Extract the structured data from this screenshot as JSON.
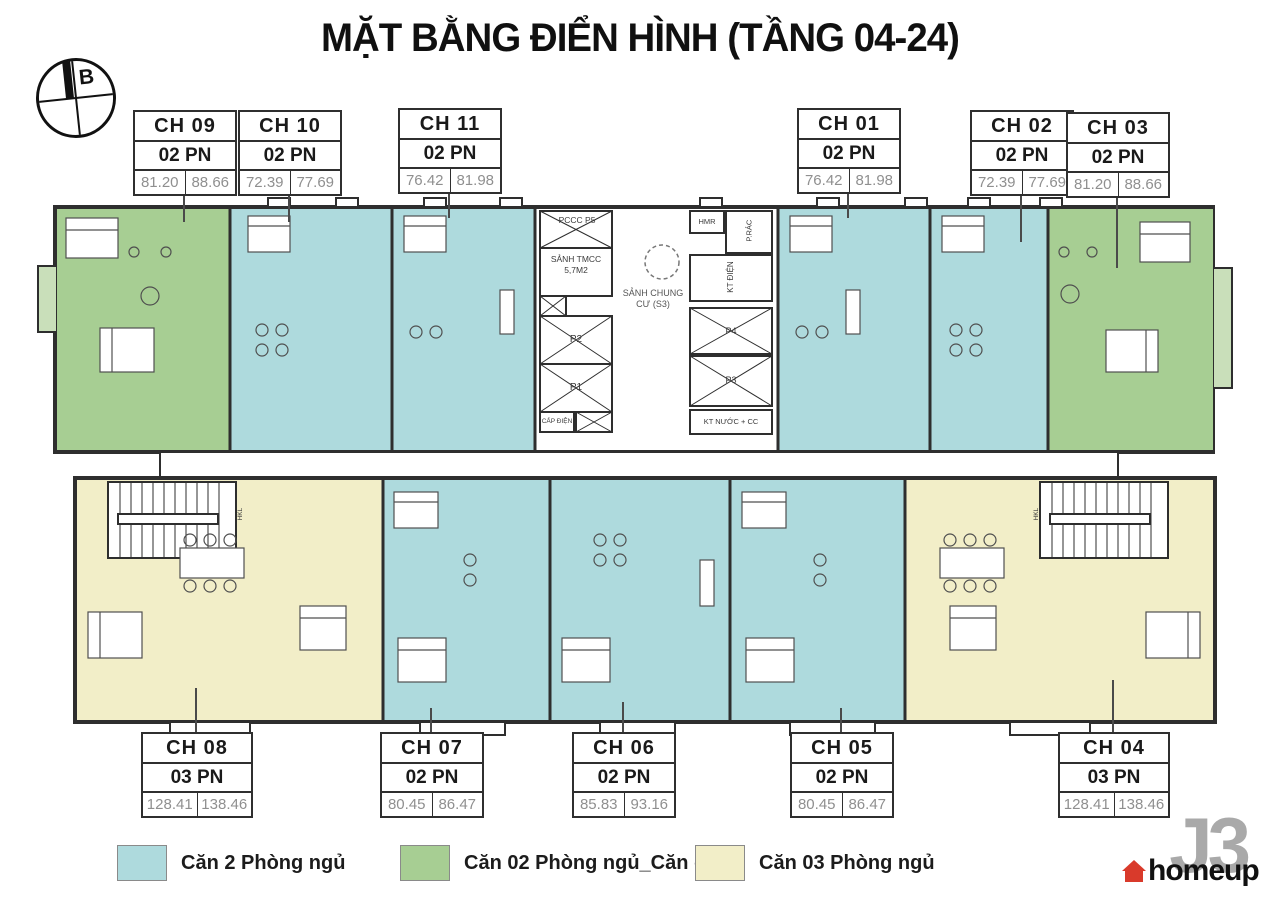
{
  "title": "MẶT BẰNG ĐIỂN HÌNH (TẦNG 04-24)",
  "compass": {
    "label": "B"
  },
  "units": [
    {
      "id": "CH09",
      "name": "CH 09",
      "bedrooms": "02 PN",
      "area1": "81.20",
      "area2": "88.66",
      "category": "2pn-corner"
    },
    {
      "id": "CH10",
      "name": "CH 10",
      "bedrooms": "02 PN",
      "area1": "72.39",
      "area2": "77.69",
      "category": "2pn"
    },
    {
      "id": "CH11",
      "name": "CH 11",
      "bedrooms": "02 PN",
      "area1": "76.42",
      "area2": "81.98",
      "category": "2pn"
    },
    {
      "id": "CH01",
      "name": "CH 01",
      "bedrooms": "02 PN",
      "area1": "76.42",
      "area2": "81.98",
      "category": "2pn"
    },
    {
      "id": "CH02",
      "name": "CH 02",
      "bedrooms": "02 PN",
      "area1": "72.39",
      "area2": "77.69",
      "category": "2pn"
    },
    {
      "id": "CH03",
      "name": "CH 03",
      "bedrooms": "02 PN",
      "area1": "81.20",
      "area2": "88.66",
      "category": "2pn-corner"
    },
    {
      "id": "CH08",
      "name": "CH 08",
      "bedrooms": "03 PN",
      "area1": "128.41",
      "area2": "138.46",
      "category": "3pn"
    },
    {
      "id": "CH07",
      "name": "CH 07",
      "bedrooms": "02 PN",
      "area1": "80.45",
      "area2": "86.47",
      "category": "2pn"
    },
    {
      "id": "CH06",
      "name": "CH 06",
      "bedrooms": "02 PN",
      "area1": "85.83",
      "area2": "93.16",
      "category": "2pn"
    },
    {
      "id": "CH05",
      "name": "CH 05",
      "bedrooms": "02 PN",
      "area1": "80.45",
      "area2": "86.47",
      "category": "2pn"
    },
    {
      "id": "CH04",
      "name": "CH 04",
      "bedrooms": "03 PN",
      "area1": "128.41",
      "area2": "138.46",
      "category": "3pn"
    }
  ],
  "core": {
    "fire_lift": "PCCC P5",
    "fire_lobby": "SẢNH TMCC 5,7M2",
    "lift_p2": "P2",
    "lift_p1": "P1",
    "power": "CẤP ĐIỆN",
    "shared_lobby": "SẢNH CHUNG CƯ (S3)",
    "hmr": "HMR",
    "trash": "P.RÁC",
    "elec_shaft": "KT ĐIỆN",
    "lift_p4": "P4",
    "lift_p3": "P3",
    "water_shaft": "KT NƯỚC + CC",
    "stair_label": "HKL"
  },
  "legend": {
    "items": [
      {
        "label": "Căn 2 Phòng ngủ",
        "color": "#aedadd"
      },
      {
        "label": "Căn 02 Phòng ngủ_Căn góc",
        "color": "#a7ce93"
      },
      {
        "label": "Căn 03 Phòng ngủ",
        "color": "#f2eec8"
      }
    ]
  },
  "logo": {
    "mark": "J3",
    "text": "homeup"
  },
  "colors": {
    "two_bedroom": "#aedadd",
    "corner_two_bedroom": "#a7ce93",
    "three_bedroom": "#f2eec8",
    "wall": "#2e2e2e"
  }
}
